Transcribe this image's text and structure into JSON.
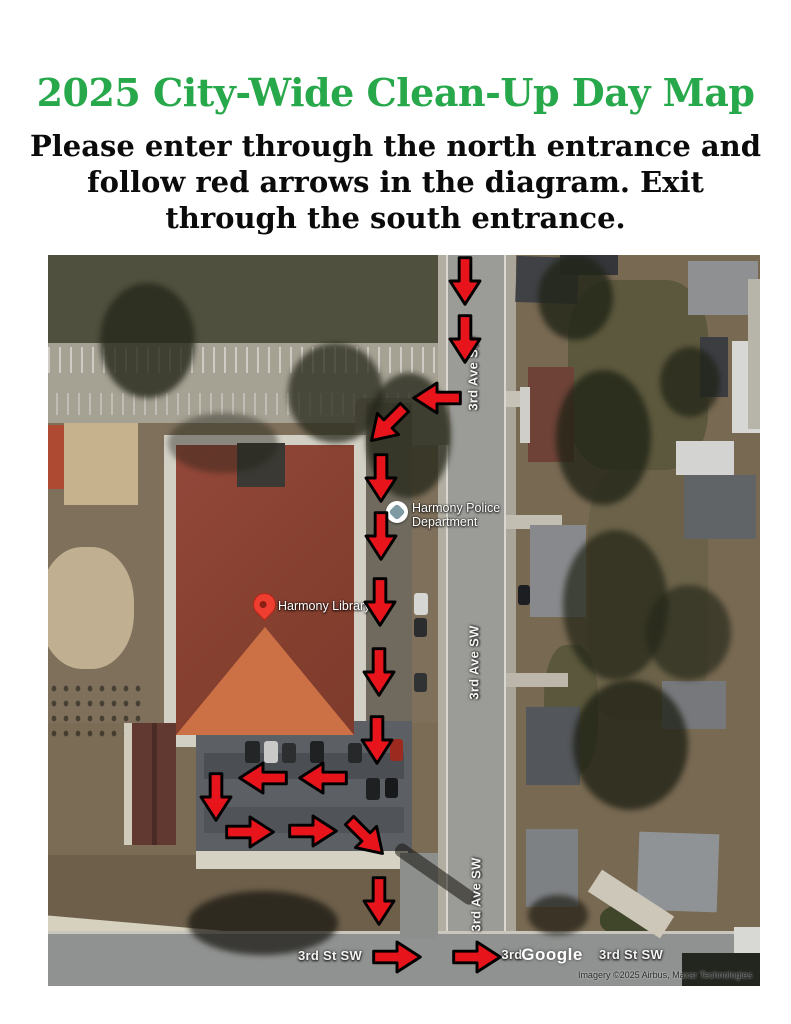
{
  "title": "2025 City-Wide Clean-Up Day Map",
  "subtitle_lines": [
    "Please enter through the north entrance and",
    "follow red arrows in the diagram. Exit",
    "through the south entrance."
  ],
  "colors": {
    "title_green": "#27a84a",
    "text_black": "#0b0b0b",
    "arrow_red": "#e8141c",
    "arrow_outline": "#000000"
  },
  "map": {
    "labels": {
      "street_top": "3rd Ave SW",
      "street_mid": "3rd Ave SW",
      "street_bottom": "3rd Ave SW",
      "cross_left": "3rd St SW",
      "cross_partial": "3rd",
      "cross_right": "3rd St SW",
      "watermark": "Google",
      "attribution": "Imagery ©2025 Airbus, Maxar Technologies",
      "police_line1": "Harmony Police",
      "police_line2": "Department",
      "library": "Harmony Library"
    },
    "route": {
      "entrance": "north entrance on 3rd Ave SW",
      "exit": "south entrance to 3rd St SW",
      "arrows": [
        {
          "x": 417,
          "y": 26,
          "rot": 90
        },
        {
          "x": 417,
          "y": 84,
          "rot": 90
        },
        {
          "x": 389,
          "y": 143,
          "rot": 180
        },
        {
          "x": 340,
          "y": 169,
          "rot": 135
        },
        {
          "x": 333,
          "y": 223,
          "rot": 90
        },
        {
          "x": 333,
          "y": 281,
          "rot": 90
        },
        {
          "x": 332,
          "y": 347,
          "rot": 90
        },
        {
          "x": 331,
          "y": 417,
          "rot": 90
        },
        {
          "x": 329,
          "y": 485,
          "rot": 90
        },
        {
          "x": 275,
          "y": 523,
          "rot": 180
        },
        {
          "x": 215,
          "y": 523,
          "rot": 180
        },
        {
          "x": 168,
          "y": 542,
          "rot": 90
        },
        {
          "x": 202,
          "y": 577,
          "rot": 0
        },
        {
          "x": 265,
          "y": 576,
          "rot": 0
        },
        {
          "x": 318,
          "y": 582,
          "rot": 45
        },
        {
          "x": 331,
          "y": 646,
          "rot": 90
        },
        {
          "x": 349,
          "y": 702,
          "rot": 0
        },
        {
          "x": 429,
          "y": 702,
          "rot": 0
        }
      ]
    }
  }
}
